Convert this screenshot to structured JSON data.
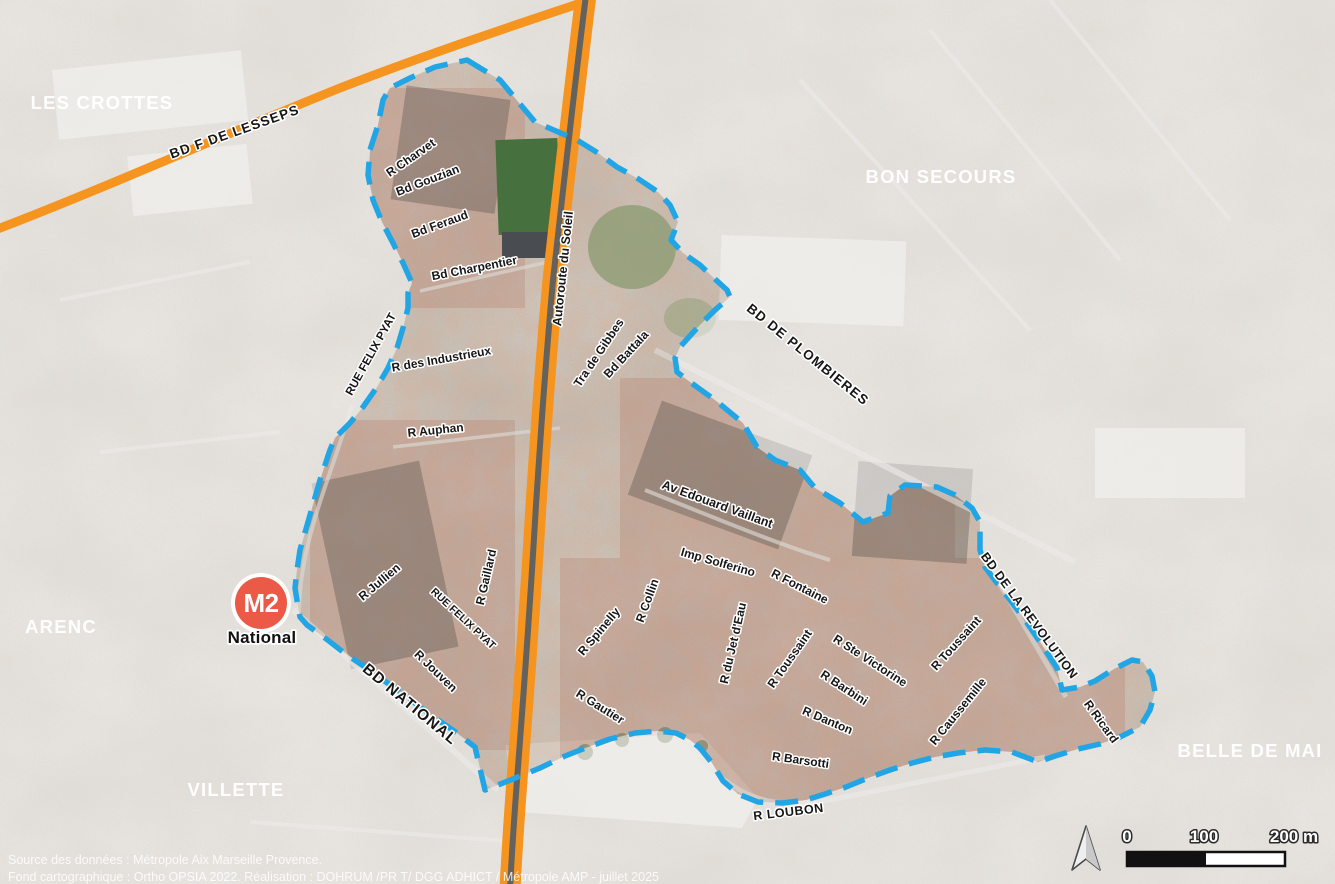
{
  "map": {
    "districts": [
      {
        "name": "LES CROTTES"
      },
      {
        "name": "BON SECOURS"
      },
      {
        "name": "ARENC"
      },
      {
        "name": "VILLETTE"
      },
      {
        "name": "BELLE DE MAI"
      }
    ],
    "streets": [
      {
        "name": "BD F DE LESSEPS"
      },
      {
        "name": "R Charvet"
      },
      {
        "name": "Bd Gouzian"
      },
      {
        "name": "Bd Feraud"
      },
      {
        "name": "Bd Charpentier"
      },
      {
        "name": "Autoroute du Soleil"
      },
      {
        "name": "BD DE PLOMBIERES"
      },
      {
        "name": "RUE FELIX PYAT"
      },
      {
        "name": "R des Industrieux"
      },
      {
        "name": "R Auphan"
      },
      {
        "name": "Tra de Gibbes"
      },
      {
        "name": "Bd Battala"
      },
      {
        "name": "Av Edouard Vaillant"
      },
      {
        "name": "Imp Solferino"
      },
      {
        "name": "R Fontaine"
      },
      {
        "name": "R Collin"
      },
      {
        "name": "R Spinelly"
      },
      {
        "name": "R du Jet d'Eau"
      },
      {
        "name": "R Toussaint"
      },
      {
        "name": "R Ste Victorine"
      },
      {
        "name": "R Barbini"
      },
      {
        "name": "R Danton"
      },
      {
        "name": "R Gautier"
      },
      {
        "name": "R Toussaint"
      },
      {
        "name": "R Caussemille"
      },
      {
        "name": "R Ricard"
      },
      {
        "name": "BD DE LA REVOLUTION"
      },
      {
        "name": "R Jullien"
      },
      {
        "name": "RUE FELIX PYAT"
      },
      {
        "name": "R Gaillard"
      },
      {
        "name": "R Jouven"
      },
      {
        "name": "BD NATIONAL"
      },
      {
        "name": "R Barsotti"
      },
      {
        "name": "R LOUBON"
      }
    ],
    "metro_station": {
      "line_badge": "M2",
      "name": "National"
    },
    "scale_bar": {
      "labels": [
        "0",
        "100",
        "200 m"
      ]
    },
    "credits": {
      "line1": "Source des données : Métropole Aix Marseille Provence.",
      "line2": "Fond cartographique : Ortho OPSIA 2022. Réalisation : DOHRUM /PR T/ DGG ADHICT / Métropole AMP - juillet 2025"
    },
    "colors": {
      "boundary_blue": "#22a5e5",
      "road_orange": "#f5941e",
      "metro_red": "#ea5a47"
    }
  }
}
